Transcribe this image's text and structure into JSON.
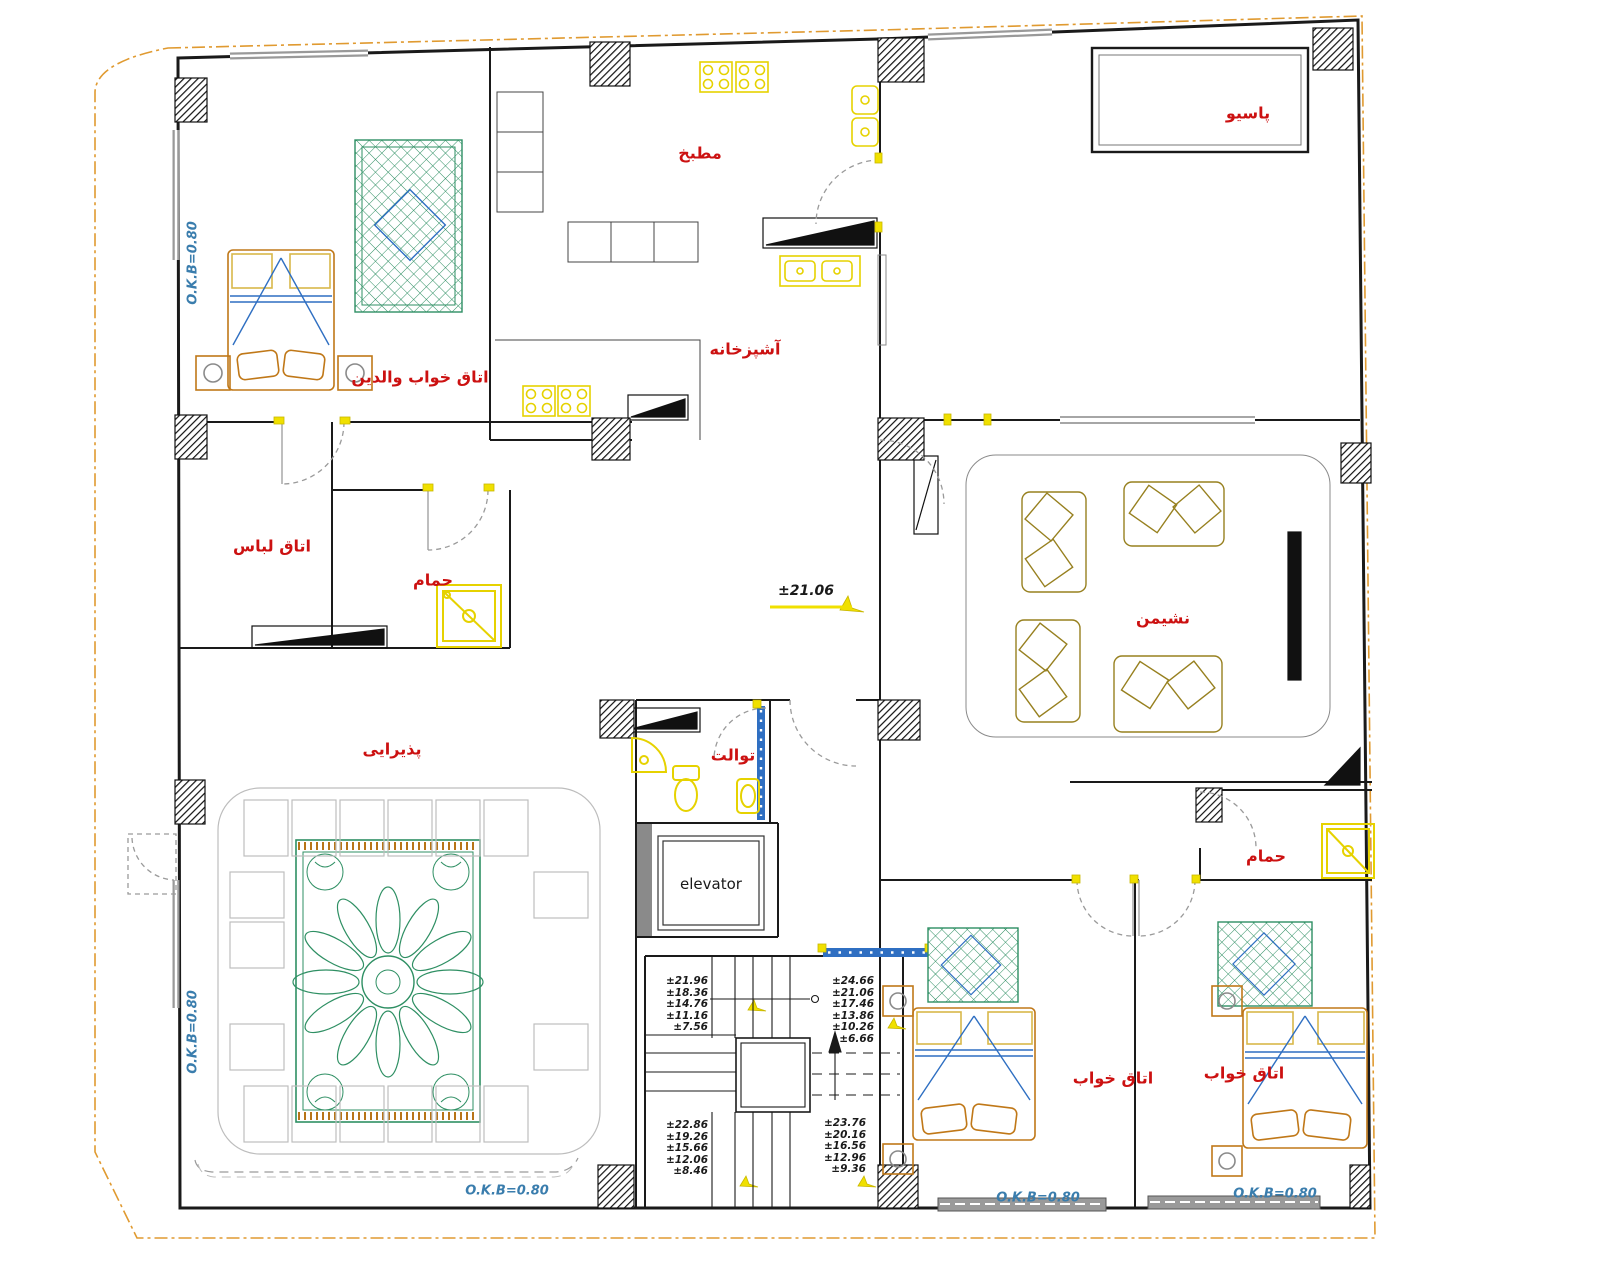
{
  "drawing": {
    "type": "architectural floor plan (residential apartment, CAD export)",
    "language": "Persian (Farsi) room labels",
    "rooms": {
      "parents_bedroom": "اتاق خواب والدین",
      "wardrobe": "اتاق لباس",
      "bath1": "حمام",
      "kitchen_top": "مطبخ",
      "kitchen_main": "آشپزخانه",
      "patio": "پاسیو",
      "living": "نشیمن",
      "reception": "پذیرایی",
      "toilet": "توالت",
      "bath2": "حمام",
      "bedroom1": "اتاق خواب",
      "bedroom2": "اتاق خواب"
    },
    "elevator": {
      "label": "elevator"
    },
    "markers": {
      "level": "±21.06",
      "okb": "O.K.B=0.80"
    },
    "stairs": {
      "upper_left": [
        "±21.96",
        "±18.36",
        "±14.76",
        "±11.16",
        "±7.56"
      ],
      "upper_right": [
        "±24.66",
        "±21.06",
        "±17.46",
        "±13.86",
        "±10.26",
        "±6.66"
      ],
      "lower_left": [
        "±22.86",
        "±19.26",
        "±15.66",
        "±12.06",
        "±8.46"
      ],
      "lower_right": [
        "±23.76",
        "±20.16",
        "±16.56",
        "±12.96",
        "±9.36"
      ]
    },
    "colors": {
      "room_label": "#cc1111",
      "okb_label": "#3a7dad",
      "boundary": "#e09a30",
      "walls": "#1a1a1a",
      "fixtures_yellow": "#e6d200",
      "rug_green": "#2e8f63",
      "furniture_orange": "#c07818",
      "accent_blue": "#2f6fc2",
      "sofa_olive": "#97801f",
      "door_arc": "#9a9a9a"
    }
  }
}
